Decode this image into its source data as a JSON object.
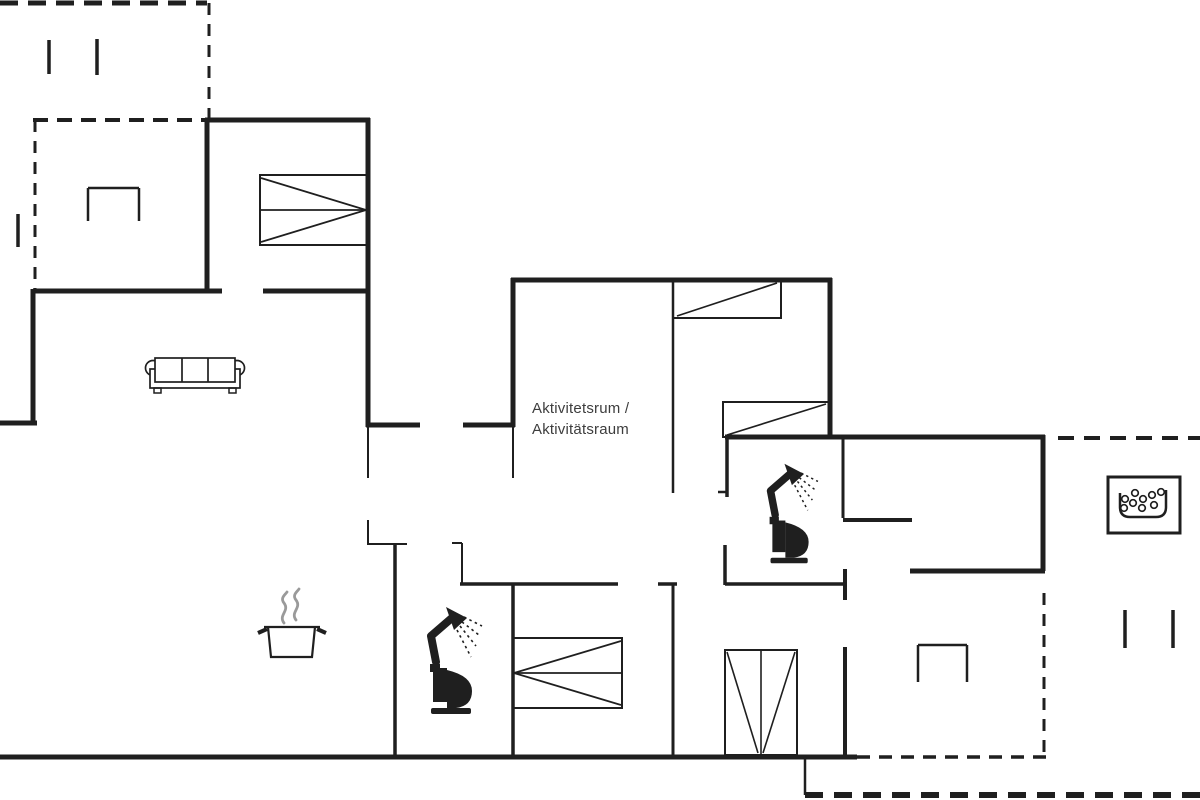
{
  "page": {
    "background": "#ffffff",
    "line_color": "#1f1f1f",
    "steam_color": "#9a9a9a",
    "label_color": "#3d3d3d"
  },
  "labels": {
    "activity_room_line1": "Aktivitetsrum /",
    "activity_room_line2": "Aktivitätsraum"
  },
  "floorplan": {
    "width": 1200,
    "height": 800,
    "walls": [
      {
        "x1": 205,
        "y1": 120,
        "x2": 370,
        "y2": 120,
        "w": 5
      },
      {
        "x1": 207,
        "y1": 118,
        "x2": 207,
        "y2": 293,
        "w": 5
      },
      {
        "x1": 368,
        "y1": 118,
        "x2": 368,
        "y2": 427,
        "w": 5
      },
      {
        "x1": 33,
        "y1": 291,
        "x2": 222,
        "y2": 291,
        "w": 5
      },
      {
        "x1": 263,
        "y1": 291,
        "x2": 370,
        "y2": 291,
        "w": 5
      },
      {
        "x1": 33,
        "y1": 289,
        "x2": 33,
        "y2": 425,
        "w": 5
      },
      {
        "x1": 0,
        "y1": 423,
        "x2": 37,
        "y2": 423,
        "w": 5
      },
      {
        "x1": 366,
        "y1": 425,
        "x2": 420,
        "y2": 425,
        "w": 5
      },
      {
        "x1": 463,
        "y1": 425,
        "x2": 515,
        "y2": 425,
        "w": 5
      },
      {
        "x1": 513,
        "y1": 278,
        "x2": 513,
        "y2": 427,
        "w": 5
      },
      {
        "x1": 511,
        "y1": 280,
        "x2": 832,
        "y2": 280,
        "w": 5
      },
      {
        "x1": 830,
        "y1": 278,
        "x2": 830,
        "y2": 439,
        "w": 5
      },
      {
        "x1": 725,
        "y1": 437,
        "x2": 1045,
        "y2": 437,
        "w": 5
      },
      {
        "x1": 1043,
        "y1": 435,
        "x2": 1043,
        "y2": 571,
        "w": 5
      },
      {
        "x1": 910,
        "y1": 571,
        "x2": 1045,
        "y2": 571,
        "w": 5
      },
      {
        "x1": 0,
        "y1": 757,
        "x2": 857,
        "y2": 757,
        "w": 5
      },
      {
        "x1": 845,
        "y1": 569,
        "x2": 845,
        "y2": 600,
        "w": 4
      },
      {
        "x1": 845,
        "y1": 647,
        "x2": 845,
        "y2": 759,
        "w": 4
      },
      {
        "x1": 395,
        "y1": 545,
        "x2": 395,
        "y2": 757,
        "w": 3.5
      },
      {
        "x1": 513,
        "y1": 584,
        "x2": 513,
        "y2": 757,
        "w": 3.5
      },
      {
        "x1": 460,
        "y1": 584,
        "x2": 618,
        "y2": 584,
        "w": 3.5
      },
      {
        "x1": 658,
        "y1": 584,
        "x2": 677,
        "y2": 584,
        "w": 3.5
      },
      {
        "x1": 673,
        "y1": 584,
        "x2": 673,
        "y2": 757,
        "w": 3
      },
      {
        "x1": 727,
        "y1": 437,
        "x2": 727,
        "y2": 497,
        "w": 3.5
      },
      {
        "x1": 725,
        "y1": 545,
        "x2": 725,
        "y2": 585,
        "w": 3.5
      },
      {
        "x1": 725,
        "y1": 584,
        "x2": 847,
        "y2": 584,
        "w": 3.5
      },
      {
        "x1": 843,
        "y1": 438,
        "x2": 843,
        "y2": 518,
        "w": 3
      },
      {
        "x1": 843,
        "y1": 520,
        "x2": 912,
        "y2": 520,
        "w": 4
      },
      {
        "x1": 673,
        "y1": 281,
        "x2": 673,
        "y2": 493,
        "w": 2.5
      },
      {
        "x1": 368,
        "y1": 427,
        "x2": 368,
        "y2": 478,
        "w": 2
      },
      {
        "x1": 513,
        "y1": 427,
        "x2": 513,
        "y2": 478,
        "w": 2
      },
      {
        "x1": 368,
        "y1": 520,
        "x2": 368,
        "y2": 545,
        "w": 2
      },
      {
        "x1": 368,
        "y1": 544,
        "x2": 407,
        "y2": 544,
        "w": 2
      },
      {
        "x1": 452,
        "y1": 543,
        "x2": 462,
        "y2": 543,
        "w": 2
      },
      {
        "x1": 462,
        "y1": 543,
        "x2": 462,
        "y2": 584,
        "w": 2
      },
      {
        "x1": 718,
        "y1": 492,
        "x2": 727,
        "y2": 492,
        "w": 2.5
      },
      {
        "x1": 805,
        "y1": 757,
        "x2": 805,
        "y2": 795,
        "w": 2.5
      }
    ],
    "dashed_walls": [
      {
        "x1": 0,
        "y1": 3,
        "x2": 207,
        "y2": 3,
        "w": 5,
        "dash": "18,10"
      },
      {
        "x1": 209,
        "y1": 3,
        "x2": 209,
        "y2": 118,
        "w": 3,
        "dash": "12,9"
      },
      {
        "x1": 33,
        "y1": 120,
        "x2": 207,
        "y2": 120,
        "w": 4,
        "dash": "15,9"
      },
      {
        "x1": 35,
        "y1": 120,
        "x2": 35,
        "y2": 291,
        "w": 3,
        "dash": "12,9"
      },
      {
        "x1": 1058,
        "y1": 438,
        "x2": 1200,
        "y2": 438,
        "w": 4,
        "dash": "16,10"
      },
      {
        "x1": 1044,
        "y1": 593,
        "x2": 1044,
        "y2": 757,
        "w": 3,
        "dash": "12,9"
      },
      {
        "x1": 857,
        "y1": 757,
        "x2": 1048,
        "y2": 757,
        "w": 3.5,
        "dash": "13,9"
      },
      {
        "x1": 805,
        "y1": 795,
        "x2": 1200,
        "y2": 795,
        "w": 6,
        "dash": "18,11"
      }
    ],
    "furniture": [
      {
        "name": "sofa",
        "type": "sofa",
        "x": 145,
        "y": 357
      },
      {
        "name": "double-bed-bedroom-1",
        "type": "bed-double",
        "x": 260,
        "y": 175,
        "w": 107,
        "h": 70,
        "converge": "right"
      },
      {
        "name": "bunk-bed-top",
        "type": "bed-single",
        "x": 673,
        "y": 281,
        "w": 108,
        "h": 37
      },
      {
        "name": "bunk-bed-bottom",
        "type": "bed-single",
        "x": 723,
        "y": 402,
        "w": 107,
        "h": 35
      },
      {
        "name": "double-bed-bedroom-2",
        "type": "bed-double",
        "x": 513,
        "y": 638,
        "w": 109,
        "h": 70,
        "converge": "left"
      },
      {
        "name": "wardrobe",
        "type": "wardrobe",
        "x": 725,
        "y": 650,
        "w": 72,
        "h": 105
      },
      {
        "name": "stove-pot-icon",
        "type": "pot",
        "x": 255,
        "y": 583
      },
      {
        "name": "toilet-shower-icon-wc",
        "type": "wc",
        "x": 424,
        "y": 604,
        "s": 1
      },
      {
        "name": "toilet-shower-icon-bathroom",
        "type": "wc",
        "x": 764,
        "y": 461,
        "s": 0.93
      },
      {
        "name": "whirlpool-icon",
        "type": "whirlpool",
        "x": 1108,
        "y": 477,
        "w": 72,
        "h": 56
      },
      {
        "name": "terrace-bench-1",
        "type": "bracket",
        "x": 88,
        "y": 188,
        "w": 51,
        "h": 33
      },
      {
        "name": "terrace-bench-2",
        "type": "bracket",
        "x": 918,
        "y": 645,
        "w": 49,
        "h": 37
      },
      {
        "name": "terrace-peg-1",
        "type": "peg",
        "x": 49,
        "y": 40,
        "len": 34
      },
      {
        "name": "terrace-peg-2",
        "type": "peg",
        "x": 97,
        "y": 39,
        "len": 36
      },
      {
        "name": "terrace-peg-3",
        "type": "peg",
        "x": 18,
        "y": 214,
        "len": 33
      },
      {
        "name": "terrace-peg-4",
        "type": "peg",
        "x": 1125,
        "y": 610,
        "len": 38
      },
      {
        "name": "terrace-peg-5",
        "type": "peg",
        "x": 1173,
        "y": 610,
        "len": 38
      }
    ]
  }
}
